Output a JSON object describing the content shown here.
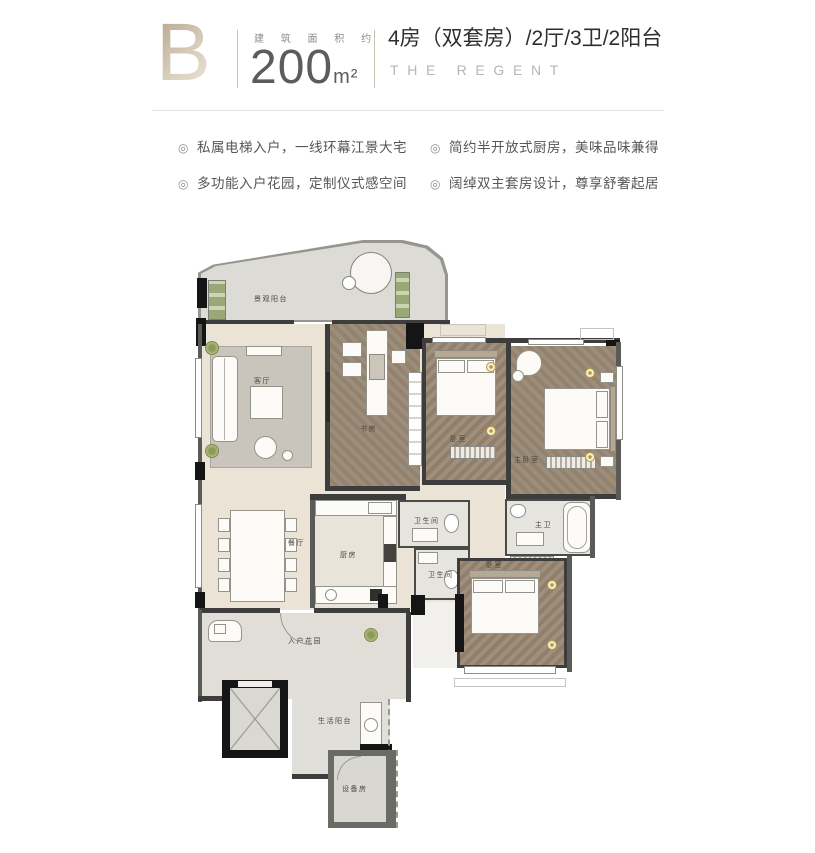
{
  "header": {
    "plan_letter": "B",
    "area_label": "建 筑 面 积 约",
    "area_value": "200",
    "area_unit": "m²",
    "title_cn": "4房（双套房）/2厅/3卫/2阳台",
    "title_en": "THE REGENT"
  },
  "features": [
    {
      "text": "私属电梯入户，一线环幕江景大宅"
    },
    {
      "text": "多功能入户花园，定制仪式感空间"
    },
    {
      "text": "简约半开放式厨房，美味品味兼得"
    },
    {
      "text": "阔绰双主套房设计，尊享舒奢起居"
    }
  ],
  "floorplan": {
    "rooms": {
      "scenic_balcony": "景观阳台",
      "living_room": "客厅",
      "study": "书房",
      "bedroom_2": "卧室",
      "master_bedroom": "主卧室",
      "dining_room": "餐厅",
      "kitchen": "厨房",
      "bathroom_1": "卫生间",
      "bathroom_2": "卫生间",
      "master_bath": "主卫",
      "bedroom_3": "卧室",
      "entry_garden": "入户花园",
      "service_balcony": "生活阳台",
      "equipment_room": "设备房"
    }
  },
  "colors": {
    "brand_beige": "#bfae94",
    "title_text": "#2e2e2e",
    "muted_text": "#b9b6b0",
    "gold_light": "#b8993a",
    "wood_floor": "#98887a",
    "wall_dark": "#151515"
  }
}
